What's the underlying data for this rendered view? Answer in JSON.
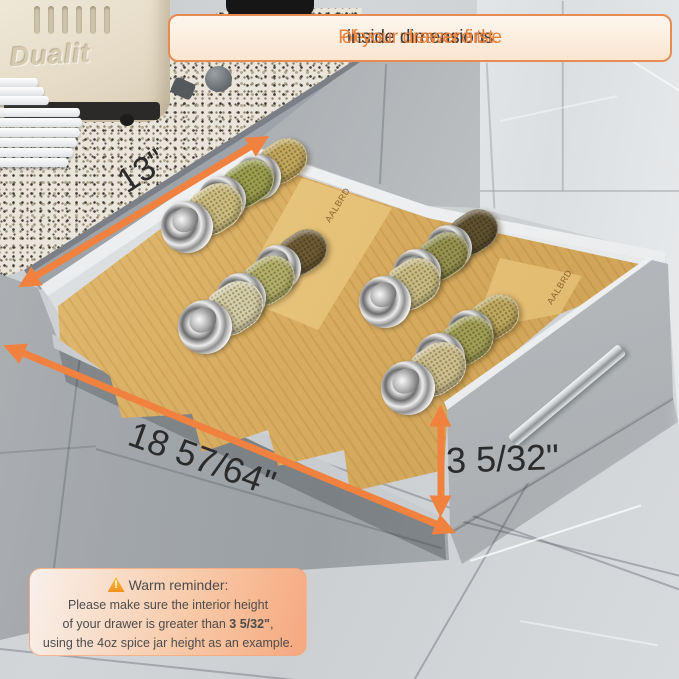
{
  "banner": {
    "part1": "Please measure the ",
    "part2": "inside dimensions",
    "part3": " of your drawer first."
  },
  "dimension_labels": {
    "width": "13\"",
    "length": "18 57/64\"",
    "height": "3 5/32\""
  },
  "reminder": {
    "title": "Warm reminder:",
    "line1": "Please make sure the interior height",
    "line2_before": "of your drawer is greater than ",
    "line2_bold": "3 5/32\"",
    "line2_after": ",",
    "line3": "using the 4oz spice jar height as an example."
  },
  "appliance": {
    "toaster_brand": "Dualit"
  },
  "organizer": {
    "material": "bamboo",
    "brand_etching": "AALBRD"
  },
  "colors": {
    "accent_orange": "#F0813F",
    "banner_border": "#E78B52",
    "banner_text_orange": "#E8823F",
    "banner_text_dark": "#3D3D3F",
    "dimension_label_dark": "#2B2B2B",
    "bamboo": "#D9AE62",
    "reminder_text": "#4C4C4C",
    "reminder_gradient_start": "#F8F1EC",
    "reminder_gradient_end": "#F5A87E"
  },
  "jars": [
    {
      "x": 258,
      "y": 177,
      "r": 23,
      "spice": "#C4A95D"
    },
    {
      "x": 222,
      "y": 200,
      "r": 24,
      "spice": "#9AA04E"
    },
    {
      "x": 187,
      "y": 227,
      "r": 26,
      "spice": "#CDBD7E"
    },
    {
      "x": 278,
      "y": 268,
      "r": 23,
      "spice": "#6E5A33"
    },
    {
      "x": 241,
      "y": 298,
      "r": 25,
      "spice": "#B4B069"
    },
    {
      "x": 205,
      "y": 327,
      "r": 27,
      "spice": "#D6CEA6"
    },
    {
      "x": 449,
      "y": 248,
      "r": 23,
      "spice": "#5F512E"
    },
    {
      "x": 417,
      "y": 273,
      "r": 24,
      "spice": "#97934F"
    },
    {
      "x": 385,
      "y": 302,
      "r": 26,
      "spice": "#C9BC82"
    },
    {
      "x": 470,
      "y": 333,
      "r": 23,
      "spice": "#C0AA5E"
    },
    {
      "x": 440,
      "y": 358,
      "r": 25,
      "spice": "#A3A055"
    },
    {
      "x": 408,
      "y": 388,
      "r": 27,
      "spice": "#CFC08D"
    }
  ]
}
